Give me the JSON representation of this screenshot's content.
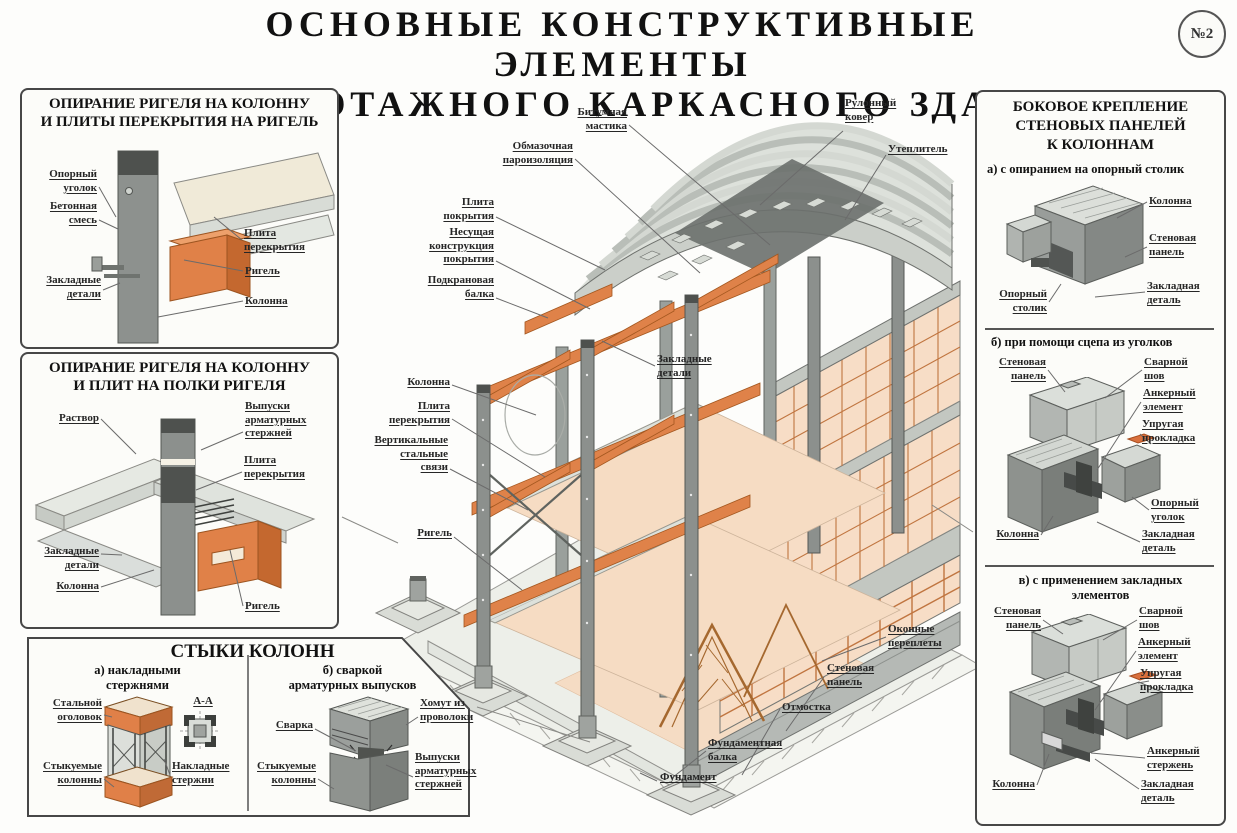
{
  "badge": "№2",
  "title": {
    "line1": "ОСНОВНЫЕ КОНСТРУКТИВНЫЕ ЭЛЕМЕНТЫ",
    "line2": "МНОГОЭТАЖНОГО КАРКАСНОГО ЗДАНИЯ"
  },
  "colors": {
    "beam_orange": "#df8249",
    "column_gray": "#8c908d",
    "floor_pink": "#f6dcc3",
    "panel_border": "#474747",
    "leader": "#6b6b6b",
    "ink": "#1f1f1f"
  },
  "panel_rigel_plita": {
    "title": "ОПИРАНИЕ РИГЕЛЯ НА КОЛОННУ\nИ ПЛИТЫ ПЕРЕКРЫТИЯ НА РИГЕЛЬ",
    "labels": [
      {
        "name": "label-oporny-ugolok",
        "text": "Опорный\nуголок",
        "x": 13,
        "y": 78,
        "w": 62,
        "align": "right",
        "line": [
          [
            77,
            97
          ],
          [
            94,
            127
          ]
        ]
      },
      {
        "name": "label-betonnaya-smes",
        "text": "Бетонная\nсмесь",
        "x": 13,
        "y": 110,
        "w": 62,
        "align": "right",
        "line": [
          [
            77,
            130
          ],
          [
            96,
            139
          ]
        ]
      },
      {
        "name": "label-zakladnye-detali",
        "text": "Закладные\nдетали",
        "x": 13,
        "y": 184,
        "w": 66,
        "align": "right",
        "line": [
          [
            81,
            200
          ],
          [
            98,
            193
          ]
        ]
      },
      {
        "name": "label-plita-perekrytiya",
        "text": "Плита\nперекрытия",
        "x": 222,
        "y": 137,
        "w": 80,
        "line": [
          [
            220,
            150
          ],
          [
            192,
            127
          ]
        ]
      },
      {
        "name": "label-rigel",
        "text": "Ригель",
        "x": 223,
        "y": 175,
        "w": 60,
        "line": [
          [
            221,
            181
          ],
          [
            162,
            170
          ]
        ]
      },
      {
        "name": "label-kolonna",
        "text": "Колонна",
        "x": 223,
        "y": 205,
        "w": 60,
        "line": [
          [
            221,
            211
          ],
          [
            136,
            227
          ]
        ]
      }
    ]
  },
  "panel_rigel_polki": {
    "title": "ОПИРАНИЕ РИГЕЛЯ НА КОЛОННУ\nИ ПЛИТ НА ПОЛКИ РИГЕЛЯ",
    "labels": [
      {
        "name": "label-rastvor",
        "text": "Раствор",
        "x": 15,
        "y": 58,
        "w": 62,
        "align": "right",
        "line": [
          [
            79,
            65
          ],
          [
            114,
            100
          ]
        ]
      },
      {
        "name": "label-vypuski-sterzhney",
        "text": "Выпуски\nарматурных\nстержней",
        "x": 223,
        "y": 46,
        "w": 80,
        "line": [
          [
            221,
            78
          ],
          [
            179,
            96
          ],
          [
            221,
            78
          ]
        ]
      },
      {
        "name": "label-plita-perekrytiya",
        "text": "Плита\nперекрытия",
        "x": 222,
        "y": 100,
        "w": 80,
        "line": [
          [
            220,
            118
          ],
          [
            174,
            136
          ]
        ]
      },
      {
        "name": "label-zakladnye-detali",
        "text": "Закладные\nдетали",
        "x": 13,
        "y": 191,
        "w": 64,
        "align": "right",
        "line": [
          [
            79,
            200
          ],
          [
            100,
            201
          ]
        ]
      },
      {
        "name": "label-kolonna",
        "text": "Колонна",
        "x": 15,
        "y": 226,
        "w": 62,
        "align": "right",
        "line": [
          [
            79,
            233
          ],
          [
            132,
            216
          ]
        ]
      },
      {
        "name": "label-rigel",
        "text": "Ригель",
        "x": 223,
        "y": 246,
        "w": 60,
        "line": [
          [
            221,
            252
          ],
          [
            208,
            196
          ]
        ]
      }
    ]
  },
  "panel_styki": {
    "title": "СТЫКИ КОЛОНН",
    "sub_a": "а) накладными\nстержнями",
    "sub_b": "б) сваркой\nарматурных выпусков",
    "labels": [
      {
        "name": "label-stalnoy-ogolovok",
        "text": "Стальной\nоголовок",
        "x": 12,
        "y": 60,
        "w": 70,
        "align": "right",
        "line": [
          [
            84,
            78
          ],
          [
            92,
            80
          ]
        ]
      },
      {
        "name": "label-stykuemye-kolonny-a",
        "text": "Стыкуемые\nколонны",
        "x": 12,
        "y": 123,
        "w": 70,
        "align": "right",
        "line": [
          [
            84,
            142
          ],
          [
            94,
            150
          ]
        ]
      },
      {
        "name": "label-nakladnye-sterzhni",
        "text": "Накладные\nстержни",
        "x": 152,
        "y": 123,
        "w": 68,
        "line": [
          [
            150,
            138
          ],
          [
            144,
            122
          ]
        ]
      },
      {
        "name": "label-section-a-a",
        "text": "А-А",
        "x": 166,
        "y": 58,
        "w": 34,
        "align": "center"
      },
      {
        "name": "label-svarka",
        "text": "Сварка",
        "x": 245,
        "y": 82,
        "w": 48,
        "align": "right",
        "line": [
          [
            295,
            92
          ],
          [
            336,
            114
          ]
        ]
      },
      {
        "name": "label-stykuemye-kolonny-b",
        "text": "Стыкуемые\nколонны",
        "x": 228,
        "y": 123,
        "w": 68,
        "align": "right",
        "line": [
          [
            298,
            142
          ],
          [
            314,
            152
          ]
        ]
      },
      {
        "name": "label-khomut",
        "text": "Хомут из\nпроволоки",
        "x": 400,
        "y": 60,
        "w": 55,
        "line": [
          [
            398,
            80
          ],
          [
            386,
            88
          ]
        ]
      },
      {
        "name": "label-vypuski-armatury",
        "text": "Выпуски\nарматурных\nстержней",
        "x": 395,
        "y": 114,
        "w": 60,
        "line": [
          [
            393,
            140
          ],
          [
            366,
            128
          ]
        ]
      }
    ]
  },
  "panel_bokovoe": {
    "title": "БОКОВОЕ КРЕПЛЕНИЕ\nСТЕНОВЫХ ПАНЕЛЕЙ\nК КОЛОННАМ",
    "sub_a": "а) с опиранием на  опорный столик",
    "sub_b": "б) при помощи сцепа из уголков",
    "sub_v": "в) с применением закладных\nэлементов",
    "labels_a": [
      {
        "name": "label-kolonna",
        "text": "Колонна",
        "x": 172,
        "y": 103,
        "w": 62,
        "line": [
          [
            170,
            110
          ],
          [
            140,
            126
          ]
        ]
      },
      {
        "name": "label-stenovaya-panel",
        "text": "Стеновая\nпанель",
        "x": 172,
        "y": 140,
        "w": 62,
        "line": [
          [
            170,
            155
          ],
          [
            148,
            165
          ]
        ]
      },
      {
        "name": "label-zakladnaya-detal",
        "text": "Закладная\nдеталь",
        "x": 170,
        "y": 188,
        "w": 64,
        "line": [
          [
            168,
            200
          ],
          [
            118,
            205
          ]
        ]
      },
      {
        "name": "label-oporny-stolik",
        "text": "Опорный\nстолик",
        "x": 8,
        "y": 196,
        "w": 62,
        "align": "right",
        "line": [
          [
            72,
            210
          ],
          [
            84,
            192
          ]
        ]
      }
    ],
    "labels_b": [
      {
        "name": "label-stenovaya-panel",
        "text": "Стеновая\nпанель",
        "x": 5,
        "y": 264,
        "w": 64,
        "align": "right",
        "line": [
          [
            71,
            278
          ],
          [
            88,
            300
          ]
        ]
      },
      {
        "name": "label-svarnoy-shov",
        "text": "Сварной\nшов",
        "x": 167,
        "y": 264,
        "w": 60,
        "line": [
          [
            165,
            278
          ],
          [
            128,
            306
          ]
        ]
      },
      {
        "name": "label-ankerny-element",
        "text": "Анкерный\nэлемент",
        "x": 166,
        "y": 295,
        "w": 62,
        "line": [
          [
            164,
            310
          ],
          [
            120,
            378
          ]
        ]
      },
      {
        "name": "label-uprugaya-prokladka",
        "text": "Упругая\nпрокладка",
        "x": 165,
        "y": 326,
        "w": 64,
        "line": [
          [
            163,
            342
          ],
          [
            174,
            352
          ]
        ]
      },
      {
        "name": "label-oporny-ugolok",
        "text": "Опорный\nуголок",
        "x": 174,
        "y": 405,
        "w": 58,
        "line": [
          [
            172,
            418
          ],
          [
            155,
            405
          ]
        ]
      },
      {
        "name": "label-zakladnaya-detal",
        "text": "Закладная\nдеталь",
        "x": 165,
        "y": 436,
        "w": 62,
        "line": [
          [
            163,
            450
          ],
          [
            120,
            430
          ]
        ]
      },
      {
        "name": "label-kolonna",
        "text": "Колонна",
        "x": 4,
        "y": 436,
        "w": 58,
        "align": "right",
        "line": [
          [
            64,
            443
          ],
          [
            76,
            424
          ]
        ]
      }
    ],
    "labels_v": [
      {
        "name": "label-stenovaya-panel",
        "text": "Стеновая\nпанель",
        "x": 2,
        "y": 513,
        "w": 62,
        "align": "right",
        "line": [
          [
            66,
            528
          ],
          [
            86,
            542
          ]
        ]
      },
      {
        "name": "label-svarnoy-shov",
        "text": "Сварной\nшов",
        "x": 162,
        "y": 513,
        "w": 60,
        "line": [
          [
            160,
            528
          ],
          [
            126,
            548
          ]
        ]
      },
      {
        "name": "label-ankerny-element",
        "text": "Анкерный\nэлемент",
        "x": 161,
        "y": 544,
        "w": 62,
        "line": [
          [
            159,
            559
          ],
          [
            118,
            618
          ]
        ]
      },
      {
        "name": "label-uprugaya-prokladka",
        "text": "Упругая\nпрокладка",
        "x": 163,
        "y": 575,
        "w": 64,
        "line": [
          [
            161,
            591
          ],
          [
            172,
            589
          ]
        ]
      },
      {
        "name": "label-ankerny-sterzhen",
        "text": "Анкерный\nстержень",
        "x": 170,
        "y": 653,
        "w": 62,
        "line": [
          [
            168,
            666
          ],
          [
            114,
            661
          ]
        ]
      },
      {
        "name": "label-zakladnaya-detal",
        "text": "Закладная\nдеталь",
        "x": 164,
        "y": 686,
        "w": 62,
        "line": [
          [
            162,
            697
          ],
          [
            118,
            667
          ]
        ]
      },
      {
        "name": "label-kolonna",
        "text": "Колонна",
        "x": 2,
        "y": 686,
        "w": 56,
        "align": "right",
        "line": [
          [
            60,
            693
          ],
          [
            72,
            662
          ]
        ]
      }
    ]
  },
  "building": {
    "labels": [
      {
        "name": "label-bitumnaya-mastika",
        "text": "Битумная\nмастика",
        "x": 180,
        "y": 21,
        "w": 107,
        "align": "right",
        "line": [
          [
            289,
            40
          ],
          [
            430,
            160
          ]
        ]
      },
      {
        "name": "label-obmazochnaya-paroizolyatsiya",
        "text": "Обмазочная\nпароизоляция",
        "x": 120,
        "y": 55,
        "w": 113,
        "align": "right",
        "line": [
          [
            235,
            74
          ],
          [
            360,
            188
          ]
        ]
      },
      {
        "name": "label-plita-pokrytiya",
        "text": "Плита\nпокрытия",
        "x": 60,
        "y": 111,
        "w": 94,
        "align": "right",
        "line": [
          [
            156,
            132
          ],
          [
            265,
            185
          ]
        ]
      },
      {
        "name": "label-nesushchaya-konstruktsiya",
        "text": "Несущая\nконструкция\nпокрытия",
        "x": 47,
        "y": 141,
        "w": 107,
        "align": "right",
        "line": [
          [
            156,
            176
          ],
          [
            250,
            224
          ]
        ]
      },
      {
        "name": "label-podkranovaya-balka",
        "text": "Подкрановая\nбалка",
        "x": 44,
        "y": 189,
        "w": 110,
        "align": "right",
        "line": [
          [
            156,
            213
          ],
          [
            208,
            233
          ]
        ]
      },
      {
        "name": "label-rulonny-kover",
        "text": "Рулонный\nковер",
        "x": 505,
        "y": 12,
        "w": 68,
        "line": [
          [
            503,
            46
          ],
          [
            420,
            120
          ]
        ]
      },
      {
        "name": "label-uteplitel",
        "text": "Утеплитель",
        "x": 548,
        "y": 58,
        "w": 72,
        "line": [
          [
            546,
            70
          ],
          [
            505,
            135
          ]
        ]
      },
      {
        "name": "label-zakladnye-detali",
        "text": "Закладные\nдетали",
        "x": 317,
        "y": 268,
        "w": 95,
        "line": [
          [
            315,
            281
          ],
          [
            262,
            256
          ],
          [
            315,
            281
          ]
        ]
      },
      {
        "name": "label-kolonna",
        "text": "Колонна",
        "x": 45,
        "y": 291,
        "w": 65,
        "align": "right",
        "line": [
          [
            112,
            300
          ],
          [
            196,
            330
          ]
        ]
      },
      {
        "name": "label-plita-perekrytiya",
        "text": "Плита\nперекрытия",
        "x": 20,
        "y": 315,
        "w": 90,
        "align": "right",
        "line": [
          [
            112,
            334
          ],
          [
            205,
            392
          ]
        ]
      },
      {
        "name": "label-vertikalnye-svyazi",
        "text": "Вертикальные\nстальные\nсвязи",
        "x": 8,
        "y": 349,
        "w": 100,
        "align": "right",
        "line": [
          [
            110,
            384
          ],
          [
            188,
            425
          ]
        ]
      },
      {
        "name": "label-rigel",
        "text": "Ригель",
        "x": 50,
        "y": 442,
        "w": 62,
        "align": "right",
        "line": [
          [
            114,
            452
          ],
          [
            182,
            505
          ]
        ]
      },
      {
        "name": "label-okonnye-perplety",
        "text": "Оконные\nпереплеты",
        "x": 548,
        "y": 538,
        "w": 85,
        "line": [
          [
            546,
            552
          ],
          [
            482,
            576
          ]
        ]
      },
      {
        "name": "label-stenovaya-panel",
        "text": "Стеновая\nпанель",
        "x": 487,
        "y": 577,
        "w": 80,
        "line": [
          [
            484,
            592
          ],
          [
            446,
            646
          ]
        ]
      },
      {
        "name": "label-otmostka",
        "text": "Отмостка",
        "x": 442,
        "y": 616,
        "w": 78,
        "line": [
          [
            440,
            624
          ],
          [
            402,
            690
          ]
        ]
      },
      {
        "name": "label-fundamentnaya-balka",
        "text": "Фундаментная\nбалка",
        "x": 368,
        "y": 652,
        "w": 100,
        "line": [
          [
            366,
            666
          ],
          [
            332,
            693
          ]
        ]
      },
      {
        "name": "label-fundament",
        "text": "Фундамент",
        "x": 320,
        "y": 686,
        "w": 92,
        "line": [
          [
            317,
            696
          ],
          [
            300,
            688
          ]
        ]
      }
    ]
  }
}
